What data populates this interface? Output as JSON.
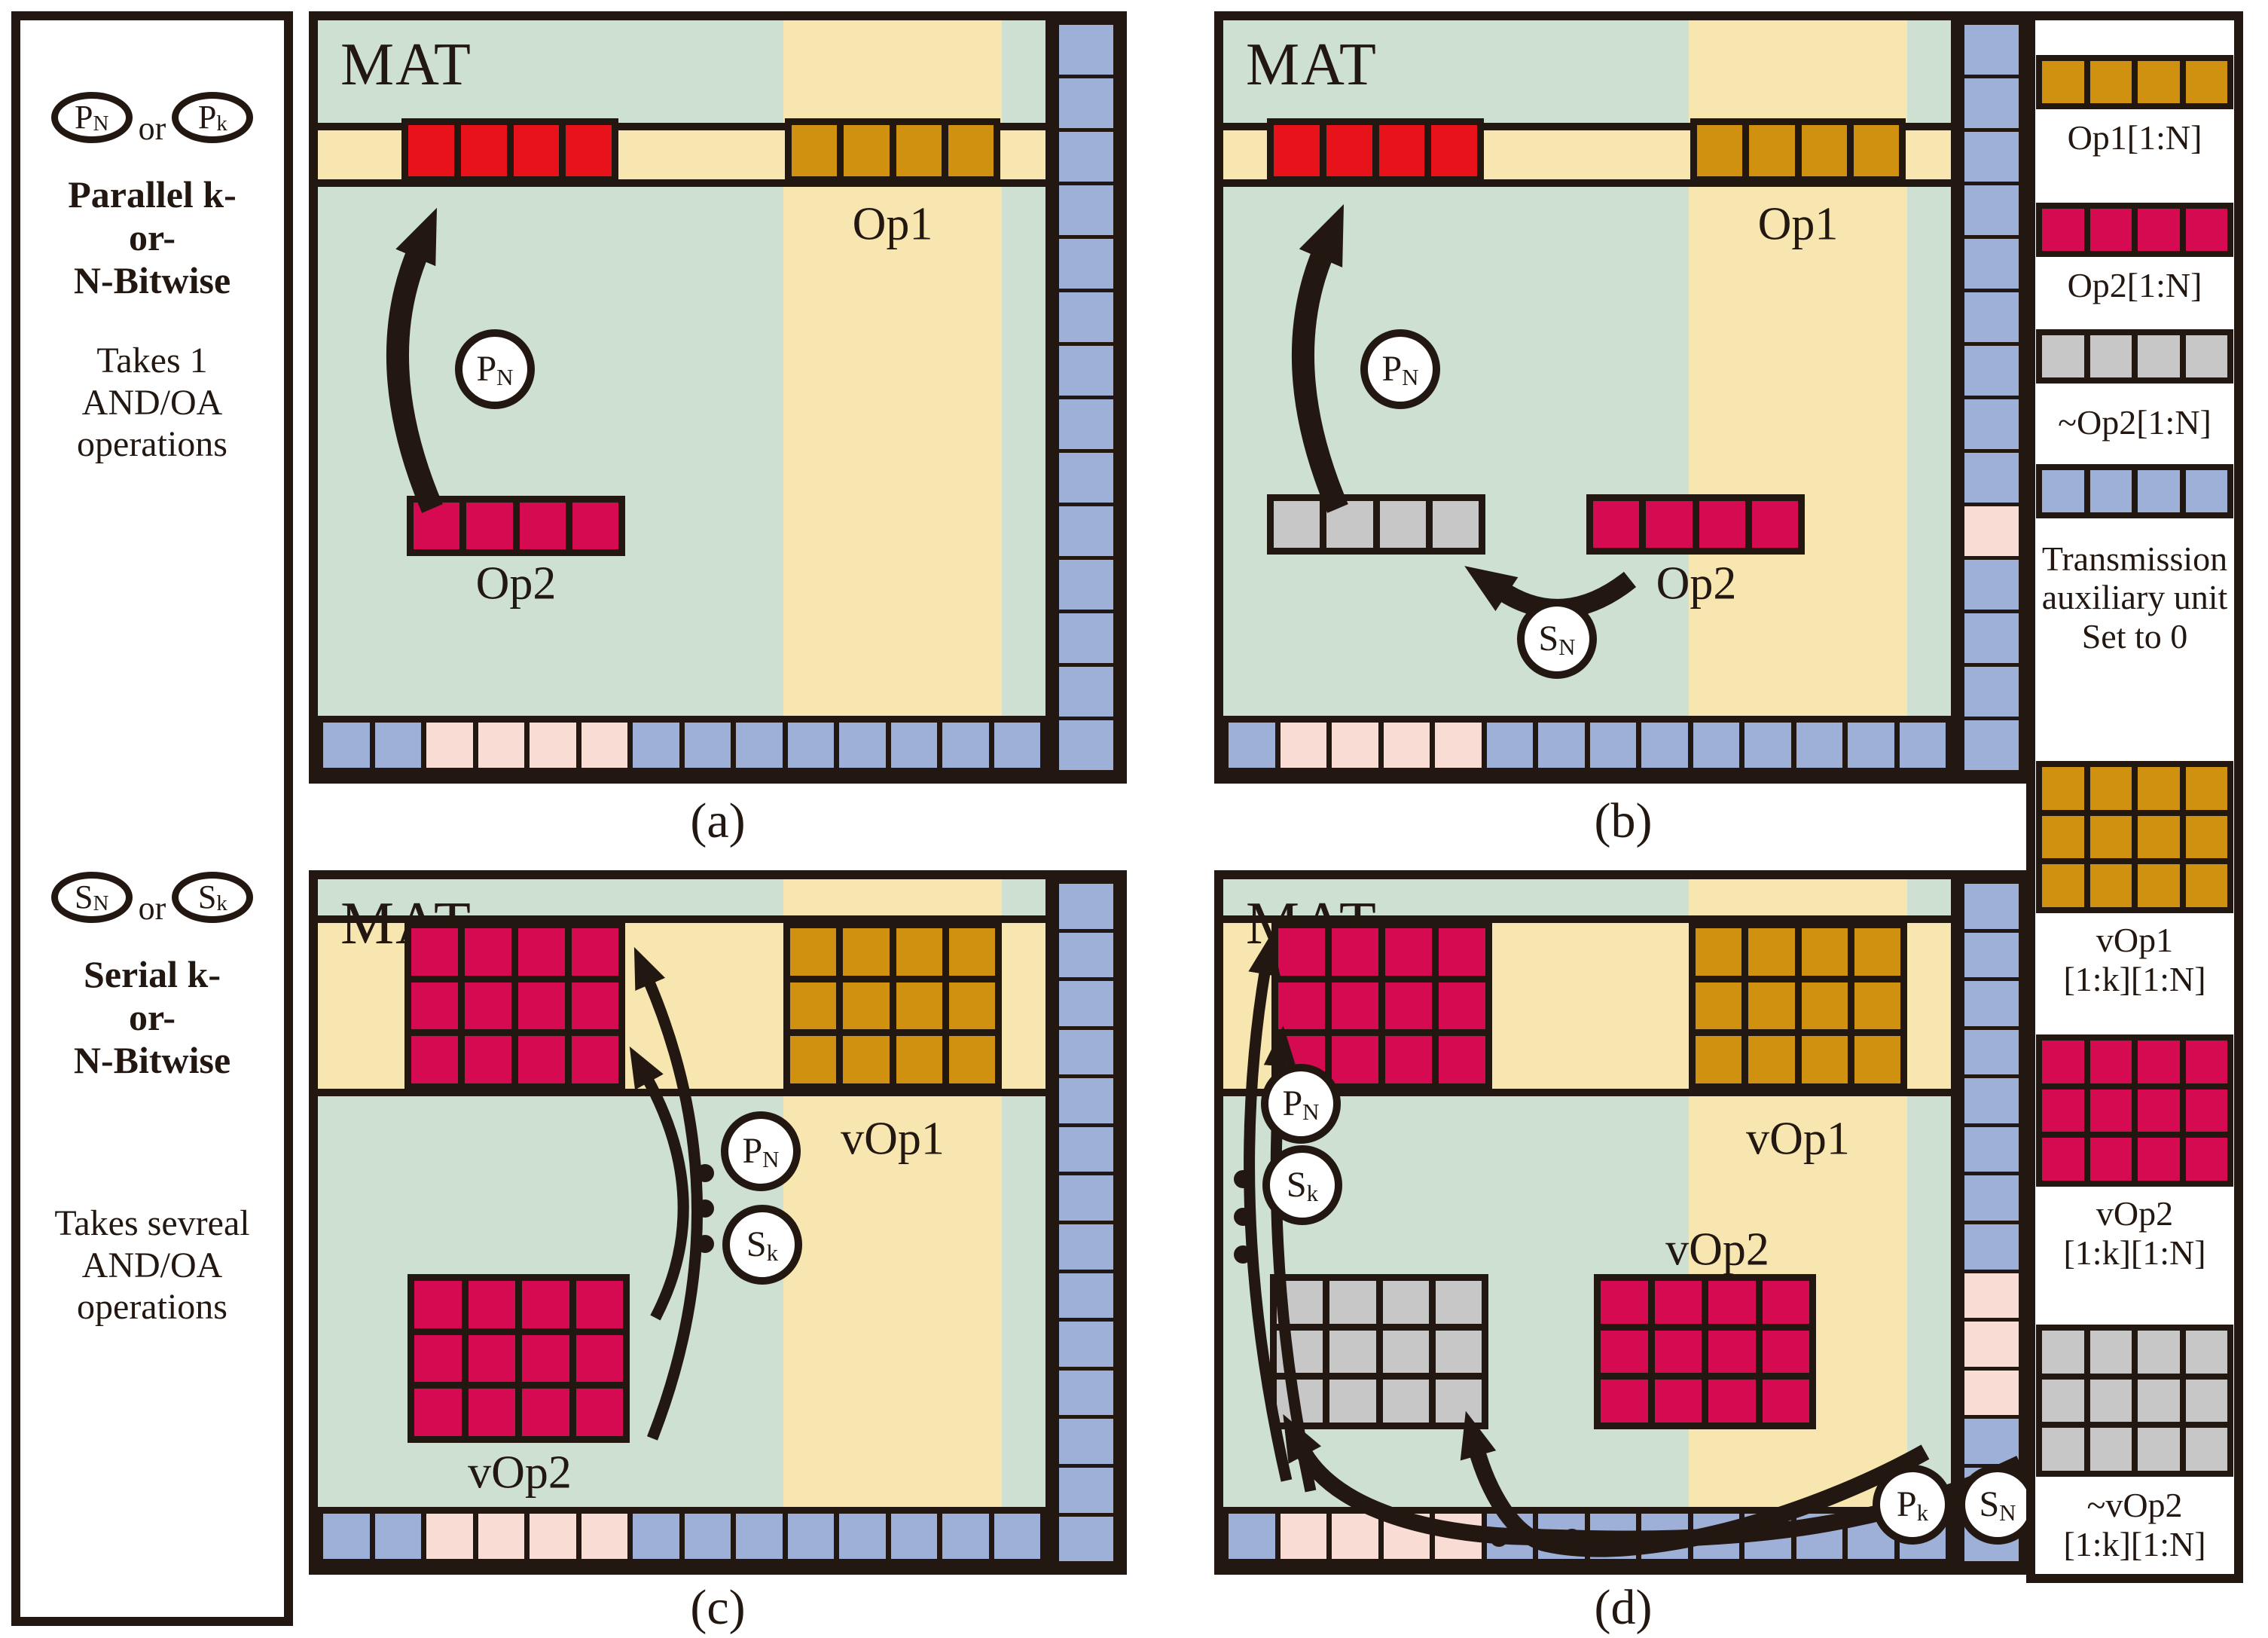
{
  "colors": {
    "ink": "#231811",
    "sage": "#cde0d2",
    "yellow": "#f7e6af",
    "red": "#e8121a",
    "crimson": "#d50a50",
    "orange": "#d19110",
    "blue": "#9fb0d8",
    "pink": "#f9dcd4",
    "gray": "#c7c7c7"
  },
  "sidebar_left": {
    "parallel": {
      "circles": [
        {
          "main": "P",
          "sub": "N"
        },
        {
          "main": "P",
          "sub": "k"
        }
      ],
      "or": "or",
      "title_lines": [
        "Parallel k-",
        "or-",
        "N-Bitwise"
      ],
      "note_lines": [
        "Takes 1",
        "AND/OA",
        "operations"
      ]
    },
    "serial": {
      "circles": [
        {
          "main": "S",
          "sub": "N"
        },
        {
          "main": "S",
          "sub": "k"
        }
      ],
      "or": "or",
      "title_lines": [
        "Serial k-",
        "or-",
        "N-Bitwise"
      ],
      "note_lines": [
        "Takes sevreal",
        "AND/OA",
        "operations"
      ]
    }
  },
  "panels": {
    "a": {
      "caption": "(a)",
      "mat": "MAT",
      "labels": {
        "op1": "Op1",
        "op2": "Op2"
      },
      "circles": {
        "pn": {
          "main": "P",
          "sub": "N"
        }
      },
      "band_block": {
        "color": "red",
        "rows": 1,
        "cols": 4
      },
      "op1_block": {
        "color": "orange",
        "rows": 1,
        "cols": 4
      },
      "op2_block": {
        "color": "crimson",
        "rows": 1,
        "cols": 4
      },
      "bottom_row": [
        "blue",
        "blue",
        "pink",
        "pink",
        "pink",
        "pink",
        "blue",
        "blue",
        "blue",
        "blue",
        "blue",
        "blue",
        "blue",
        "blue"
      ],
      "right_column": [
        "blue",
        "blue",
        "blue",
        "blue",
        "blue",
        "blue",
        "blue",
        "blue",
        "blue",
        "blue",
        "blue",
        "blue",
        "blue",
        "blue"
      ]
    },
    "b": {
      "caption": "(b)",
      "mat": "MAT",
      "labels": {
        "op1": "Op1",
        "op2": "Op2"
      },
      "circles": {
        "sn": {
          "main": "S",
          "sub": "N"
        }
      },
      "band_block": {
        "color": "red",
        "rows": 1,
        "cols": 4
      },
      "op1_block": {
        "color": "orange",
        "rows": 1,
        "cols": 4
      },
      "gray_block": {
        "color": "gray",
        "rows": 1,
        "cols": 4
      },
      "op2_block": {
        "color": "crimson",
        "rows": 1,
        "cols": 4
      },
      "bottom_row": [
        "blue",
        "pink",
        "pink",
        "pink",
        "pink",
        "blue",
        "blue",
        "blue",
        "blue",
        "blue",
        "blue",
        "blue",
        "blue",
        "blue"
      ],
      "right_column": [
        "blue",
        "blue",
        "blue",
        "blue",
        "blue",
        "blue",
        "blue",
        "blue",
        "blue",
        "pink",
        "blue",
        "blue",
        "blue",
        "blue"
      ]
    },
    "c": {
      "caption": "(c)",
      "mat": "MAT",
      "labels": {
        "vop1": "vOp1",
        "vop2": "vOp2"
      },
      "circles": {
        "pn": {
          "main": "P",
          "sub": "N"
        },
        "sk": {
          "main": "S",
          "sub": "k"
        }
      },
      "band_block": {
        "color": "crimson",
        "rows": 3,
        "cols": 4
      },
      "vop1_block": {
        "color": "orange",
        "rows": 3,
        "cols": 4
      },
      "vop2_block": {
        "color": "crimson",
        "rows": 3,
        "cols": 4
      },
      "bottom_row": [
        "blue",
        "blue",
        "pink",
        "pink",
        "pink",
        "pink",
        "blue",
        "blue",
        "blue",
        "blue",
        "blue",
        "blue",
        "blue",
        "blue"
      ],
      "right_column": [
        "blue",
        "blue",
        "blue",
        "blue",
        "blue",
        "blue",
        "blue",
        "blue",
        "blue",
        "blue",
        "blue",
        "blue",
        "blue",
        "blue"
      ]
    },
    "d": {
      "caption": "(d)",
      "mat": "MAT",
      "labels": {
        "vop1": "vOp1",
        "vop2": "vOp2"
      },
      "circles": {
        "pn": {
          "main": "P",
          "sub": "N"
        },
        "sk": {
          "main": "S",
          "sub": "k"
        },
        "pk": {
          "main": "P",
          "sub": "k"
        },
        "sn": {
          "main": "S",
          "sub": "N"
        }
      },
      "band_block": {
        "color": "crimson",
        "rows": 3,
        "cols": 4
      },
      "vop1_block": {
        "color": "orange",
        "rows": 3,
        "cols": 4
      },
      "gray_block": {
        "color": "gray",
        "rows": 3,
        "cols": 4
      },
      "vop2_block": {
        "color": "crimson",
        "rows": 3,
        "cols": 4
      },
      "bottom_row": [
        "blue",
        "pink",
        "pink",
        "pink",
        "pink",
        "blue",
        "blue",
        "blue",
        "blue",
        "blue",
        "blue",
        "blue",
        "blue",
        "blue"
      ],
      "right_column": [
        "blue",
        "blue",
        "blue",
        "blue",
        "blue",
        "blue",
        "blue",
        "blue",
        "pink",
        "pink",
        "pink",
        "blue",
        "blue",
        "blue"
      ]
    }
  },
  "legend": {
    "entries": [
      {
        "block": {
          "color": "orange",
          "rows": 1,
          "cols": 4
        },
        "label_lines": [
          "Op1[1:N]"
        ]
      },
      {
        "block": {
          "color": "crimson",
          "rows": 1,
          "cols": 4
        },
        "label_lines": [
          "Op2[1:N]"
        ]
      },
      {
        "block": {
          "color": "gray",
          "rows": 1,
          "cols": 4
        },
        "label_lines": [
          "~Op2[1:N]"
        ]
      },
      {
        "block": {
          "color": "blue",
          "rows": 1,
          "cols": 4
        },
        "label_lines": [
          "Transmission",
          "auxiliary unit",
          "Set to 0"
        ]
      },
      {
        "block": {
          "color": "orange",
          "rows": 3,
          "cols": 4
        },
        "label_lines": [
          "vOp1",
          "[1:k][1:N]"
        ]
      },
      {
        "block": {
          "color": "crimson",
          "rows": 3,
          "cols": 4
        },
        "label_lines": [
          "vOp2",
          "[1:k][1:N]"
        ]
      },
      {
        "block": {
          "color": "gray",
          "rows": 3,
          "cols": 4
        },
        "label_lines": [
          "~vOp2",
          "[1:k][1:N]"
        ]
      }
    ]
  }
}
